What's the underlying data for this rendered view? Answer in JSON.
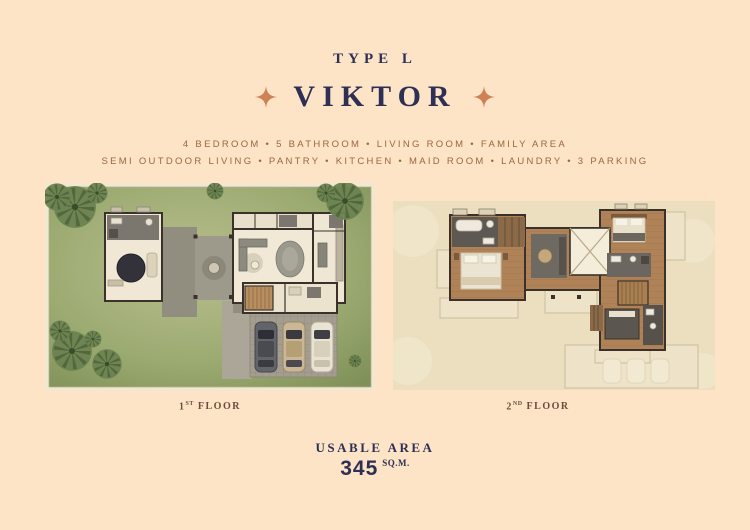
{
  "title": {
    "type_label": "TYPE L",
    "name": "VIKTOR"
  },
  "features": {
    "line1": "4 BEDROOM • 5 BATHROOM • LIVING ROOM • FAMILY AREA",
    "line2": "SEMI OUTDOOR LIVING • PANTRY • KITCHEN • MAID ROOM • LAUNDRY • 3 PARKING"
  },
  "plans": [
    {
      "id": "first-floor",
      "num": "1",
      "sup": "ST",
      "rest": "FLOOR"
    },
    {
      "id": "second-floor",
      "num": "2",
      "sup": "ND",
      "rest": "FLOOR"
    }
  ],
  "usable_area": {
    "label": "USABLE AREA",
    "value": "345",
    "unit": "SQ.M."
  },
  "icons": {
    "left_star": "four-point-star",
    "right_star": "four-point-star"
  },
  "colors": {
    "background": "#fde4c6",
    "navy": "#2d3054",
    "accent_star": "#cf8156",
    "feature_text": "#9c6640",
    "floor_label": "#6f4c3e",
    "lawn_green": "#9cab72",
    "wood_floor": "#b08257",
    "plan2_background": "#ebdfc0",
    "car_colors": [
      "#63646a",
      "#c9b795",
      "#e9e3d3"
    ]
  }
}
